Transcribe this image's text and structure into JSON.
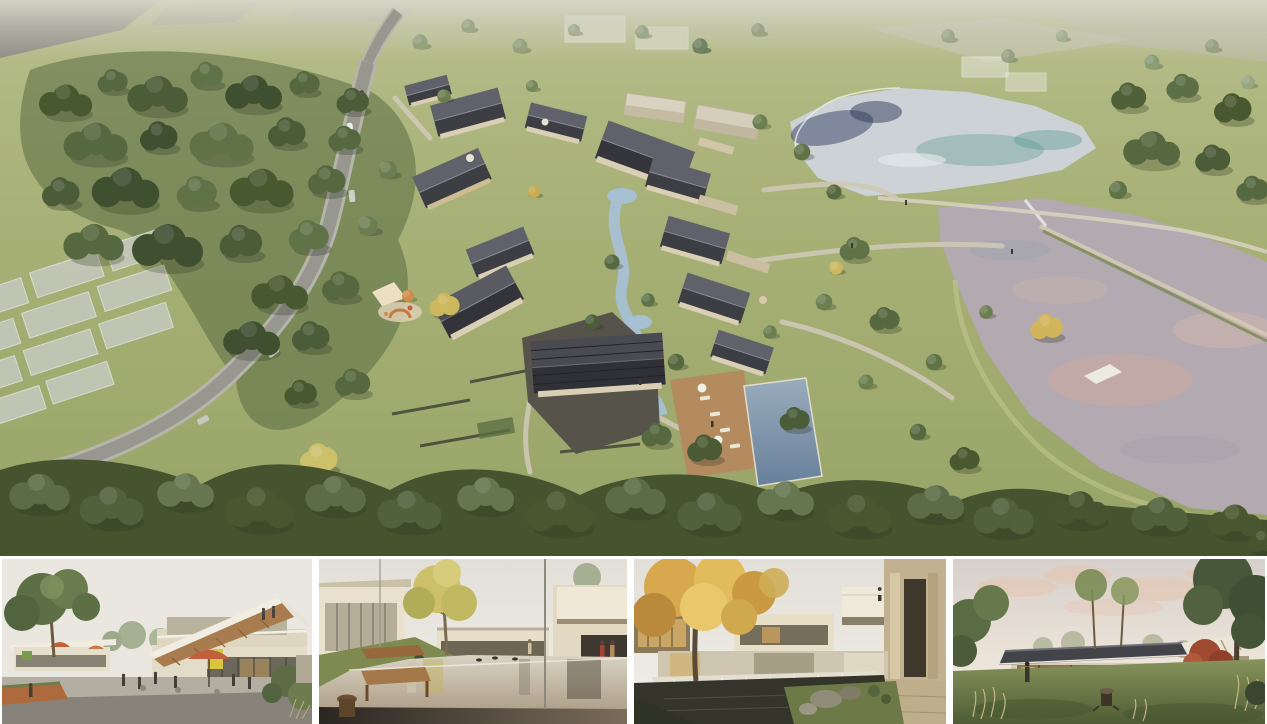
{
  "board": {
    "label": "architecture-rendering-board",
    "main_view": {
      "label": "aerial-masterplan-rendering"
    },
    "thumbnails": [
      {
        "label": "plaza-cafe-street-rendering"
      },
      {
        "label": "water-courtyard-bench-rendering"
      },
      {
        "label": "sycamore-pond-waterfall-rendering"
      },
      {
        "label": "dusk-pavilion-lawn-rendering"
      }
    ]
  },
  "colors": {
    "canvas": "#ffffff",
    "grass": "#a3ad72",
    "forest": "#4b5a36",
    "road": "#97978f",
    "road_shoulder": "#b5b5ac",
    "roof_dark": "#3d3e44",
    "roof_light": "#60616a",
    "house_wall": "#d9cfb4",
    "upper_lake_teal": "#6fa29e",
    "upper_lake_silver": "#cdd2d6",
    "lower_lake_mauve": "#b2a9b1",
    "lower_lake_pink": "#cfa9a0",
    "pool_water": "#7e93a8",
    "stream_water": "#a6c0d3",
    "stone_path": "#cfc8b6",
    "dark_courtyard": "#56534b",
    "pool_deck": "#b48a5f",
    "corten_planter": "#ad6a3c",
    "thumb_sky": "#eae7e0",
    "dusk_cloud": "#e5c6b2",
    "autumn_foliage": "#d8a84e",
    "yellow_tree": "#ccc06a",
    "bench_wood": "#a5784a",
    "umbrella_red": "#c0603c",
    "moss_green": "#6d7a48",
    "dark_pond": "#34342a"
  }
}
